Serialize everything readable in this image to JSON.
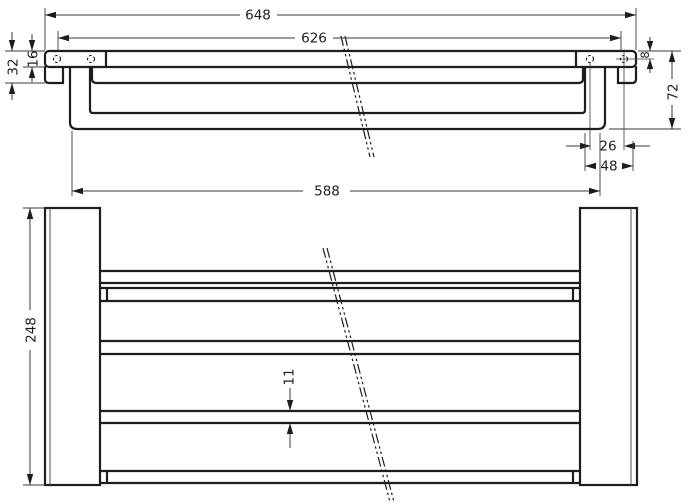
{
  "drawing": {
    "type": "technical-dimension-drawing",
    "views": [
      "front-elevation",
      "bottom-view"
    ],
    "colors": {
      "line": "#1d1d1b",
      "background": "#ffffff"
    }
  },
  "dims": {
    "total_width": "648",
    "inner_width": "626",
    "bar_length": "588",
    "end_height": "32",
    "shelf_thickness": "16",
    "hole_offset": "8",
    "overall_drop": "72",
    "hole_spacing": "26",
    "bracket_width": "48",
    "depth": "248",
    "slat_thickness": "11"
  }
}
